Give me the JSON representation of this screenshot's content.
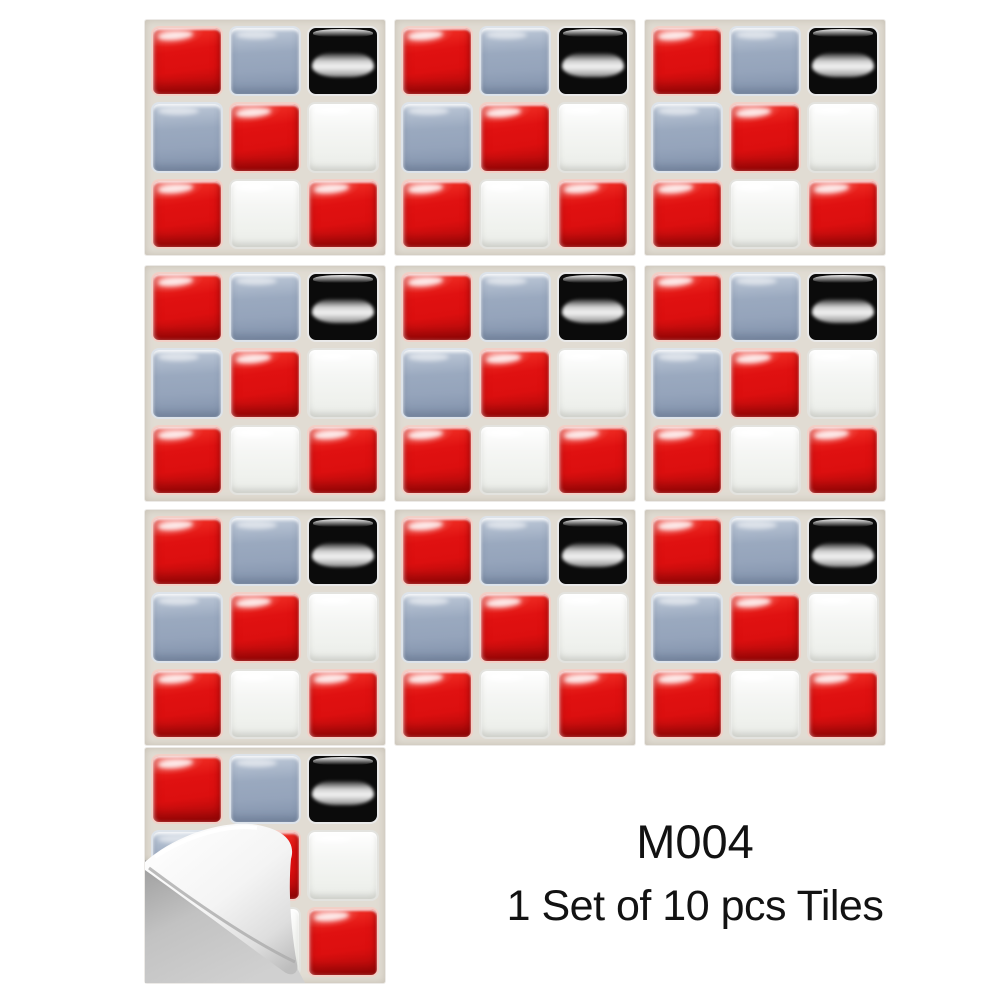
{
  "caption": {
    "code": "M004",
    "set_label": "1 Set of 10 pcs Tiles"
  },
  "tile_sheet": {
    "sheets_total": 10,
    "mosaic_pattern": [
      [
        "red",
        "blue",
        "black"
      ],
      [
        "blue",
        "red",
        "white"
      ],
      [
        "red",
        "white",
        "red"
      ]
    ],
    "peeled_sheet_index": 10
  },
  "layout_grid": {
    "columns": 3,
    "row_sheet_counts": [
      3,
      3,
      3,
      1
    ]
  },
  "colors": {
    "red": "#e01111",
    "blue_gray": "#95a4bb",
    "black": "#0b0b0b",
    "white_tile": "#f5f6f4",
    "grout": "#e1dcd3",
    "page_background": "#ffffff",
    "under_peel_gray": "#c2c2c2",
    "peel_backing": "#f4f4f4",
    "caption_text": "#121212"
  }
}
